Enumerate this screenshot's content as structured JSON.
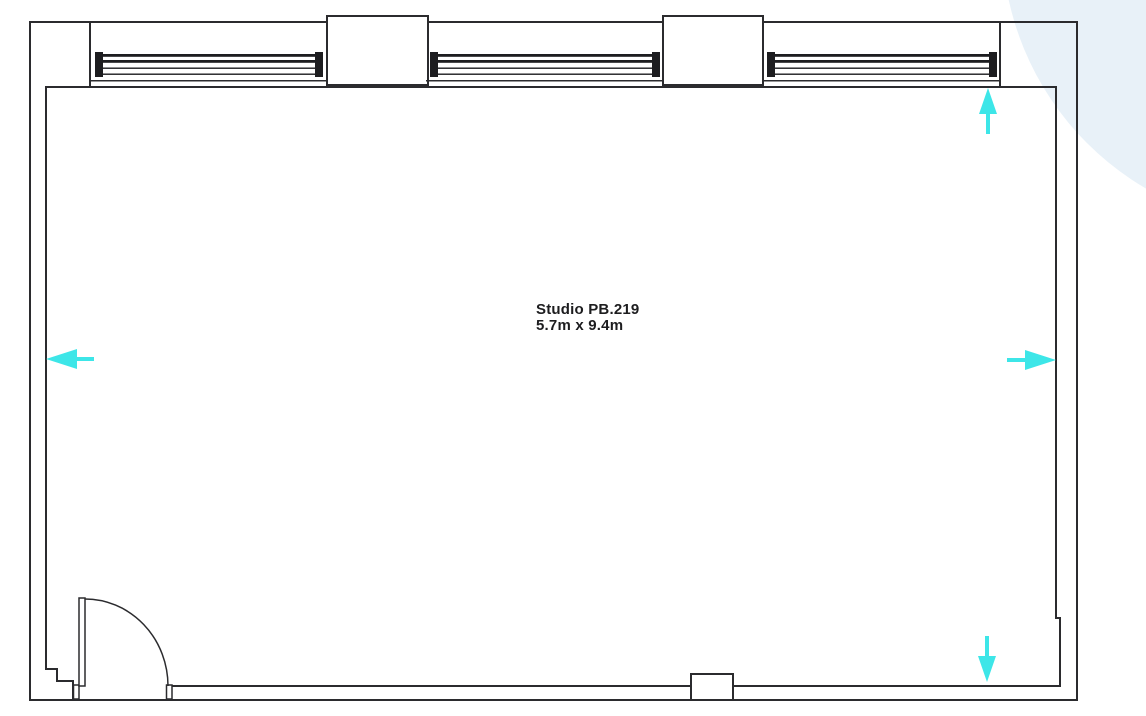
{
  "room": {
    "name": "Studio PB.219",
    "dimensions": "5.7m x 9.4m"
  },
  "colors": {
    "wall_line": "#2b2b2e",
    "arrow": "#3de6e8",
    "corner_accent": "#e8f1f8",
    "label_text": "#1d1d1f"
  },
  "plan": {
    "windows": [
      "window-1",
      "window-2",
      "window-3"
    ],
    "door": "hinged door, bottom-left, quarter-circle swing",
    "arrows": [
      {
        "position": "top-right",
        "direction": "up"
      },
      {
        "position": "middle-right",
        "direction": "right"
      },
      {
        "position": "bottom-right",
        "direction": "down"
      },
      {
        "position": "middle-left",
        "direction": "left"
      }
    ]
  }
}
